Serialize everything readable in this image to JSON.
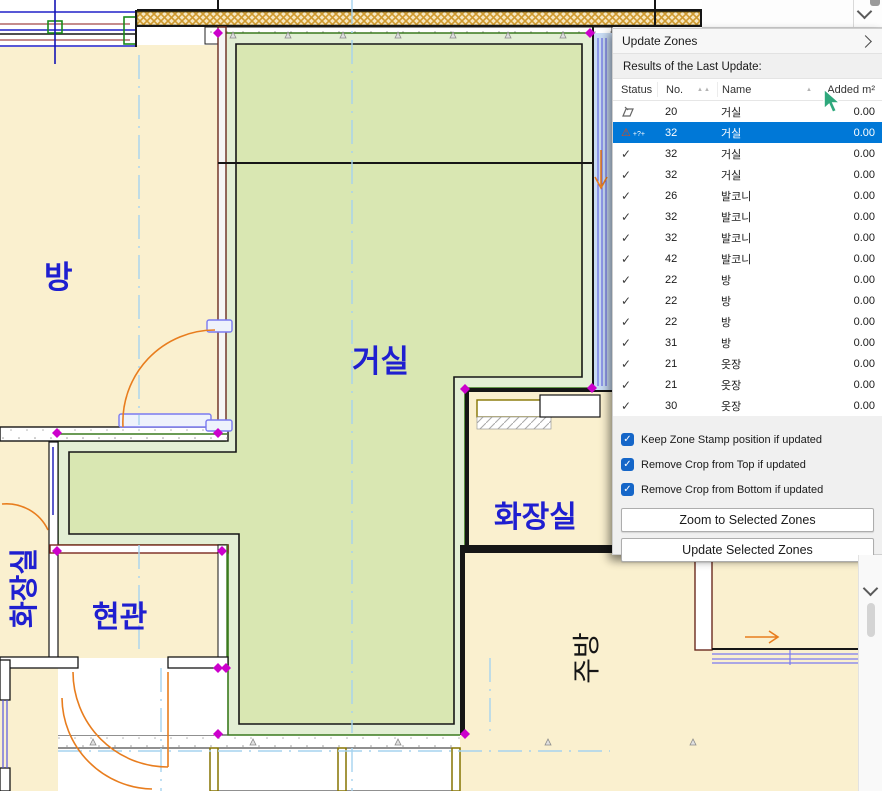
{
  "panel": {
    "title": "Update Zones",
    "results_label": "Results of the Last Update:",
    "columns": {
      "status": "Status",
      "no": "No.",
      "name": "Name",
      "added": "Added m²"
    },
    "sort_indicator_no": "▲▲",
    "sort_indicator_name": "▲",
    "rows": [
      {
        "status": "stamp",
        "no": "20",
        "name": "거실",
        "added": "0.00",
        "selected": false
      },
      {
        "status": "warning",
        "no": "32",
        "name": "거실",
        "added": "0.00",
        "selected": true
      },
      {
        "status": "check",
        "no": "32",
        "name": "거실",
        "added": "0.00",
        "selected": false
      },
      {
        "status": "check",
        "no": "32",
        "name": "거실",
        "added": "0.00",
        "selected": false
      },
      {
        "status": "check",
        "no": "26",
        "name": "발코니",
        "added": "0.00",
        "selected": false
      },
      {
        "status": "check",
        "no": "32",
        "name": "발코니",
        "added": "0.00",
        "selected": false
      },
      {
        "status": "check",
        "no": "32",
        "name": "발코니",
        "added": "0.00",
        "selected": false
      },
      {
        "status": "check",
        "no": "42",
        "name": "발코니",
        "added": "0.00",
        "selected": false
      },
      {
        "status": "check",
        "no": "22",
        "name": "방",
        "added": "0.00",
        "selected": false
      },
      {
        "status": "check",
        "no": "22",
        "name": "방",
        "added": "0.00",
        "selected": false
      },
      {
        "status": "check",
        "no": "22",
        "name": "방",
        "added": "0.00",
        "selected": false
      },
      {
        "status": "check",
        "no": "31",
        "name": "방",
        "added": "0.00",
        "selected": false
      },
      {
        "status": "check",
        "no": "21",
        "name": "옷장",
        "added": "0.00",
        "selected": false
      },
      {
        "status": "check",
        "no": "21",
        "name": "옷장",
        "added": "0.00",
        "selected": false
      },
      {
        "status": "check",
        "no": "30",
        "name": "옷장",
        "added": "0.00",
        "selected": false
      }
    ],
    "checkboxes": [
      {
        "label": "Keep Zone Stamp position if updated",
        "checked": true
      },
      {
        "label": "Remove Crop from Top if updated",
        "checked": true
      },
      {
        "label": "Remove Crop from Bottom if updated",
        "checked": true
      }
    ],
    "buttons": {
      "zoom": "Zoom to Selected Zones",
      "update": "Update Selected Zones"
    }
  },
  "icons": {
    "check": "✓",
    "warning": "⚠",
    "warning_note": "+?+"
  },
  "plan": {
    "labels": {
      "room_top_left": "방",
      "living": "거실",
      "bath_right": "화장실",
      "bath_left": "화장실",
      "entrance": "현관",
      "kitchen": "주방"
    }
  },
  "colors": {
    "selection_blue": "#0078d7",
    "label_blue": "#1f1fd0",
    "zone_green_fill": "#d9e7b2",
    "zone_band": "#e3efd4",
    "room_cream": "#faf0cf",
    "door_orange": "#e87d1e",
    "handle_magenta": "#cc00cc",
    "cursor_green": "#2fa87c",
    "checkbox_blue": "#1566c8",
    "insulation_hatch": "#cf9a30"
  }
}
